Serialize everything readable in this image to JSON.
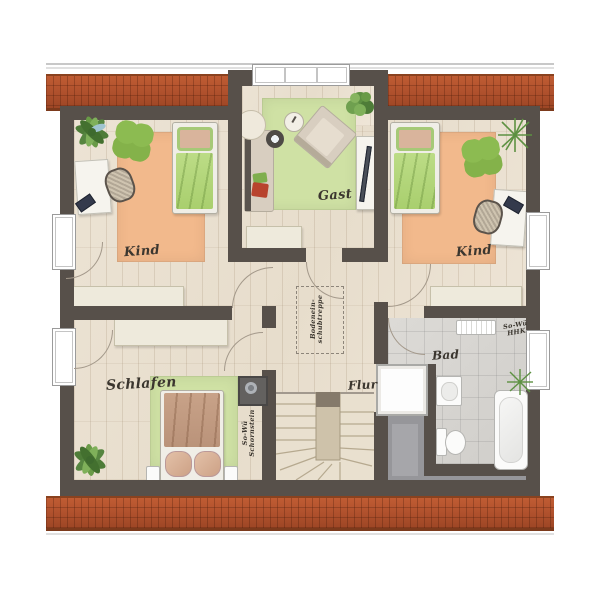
{
  "labels": {
    "room_kind_left": "Kind",
    "room_gast": "Gast",
    "room_kind_right": "Kind",
    "room_schlafen": "Schlafen",
    "room_flur": "Flur",
    "room_bad": "Bad",
    "chimney_line1": "So-Wü",
    "chimney_line2": "Schornstein",
    "radiator_line1": "So-Wü",
    "radiator_line2": "HHK",
    "attic_line1": "Bodenein-",
    "attic_line2": "schubtreppe"
  },
  "colors": {
    "wall": "#57504a",
    "roof_tile": "#b0512d",
    "wood_floor": "#e8dfd0",
    "bath_tile": "#d6d4d0",
    "void_gray": "#96969a",
    "rug_orange": "#f2b98c",
    "rug_green": "#cfe1a4",
    "bed_green": "#b3d77c",
    "duvet_brown": "#c29e85",
    "furniture_cream": "#eeeadc",
    "label_ink": "#3b362f"
  }
}
